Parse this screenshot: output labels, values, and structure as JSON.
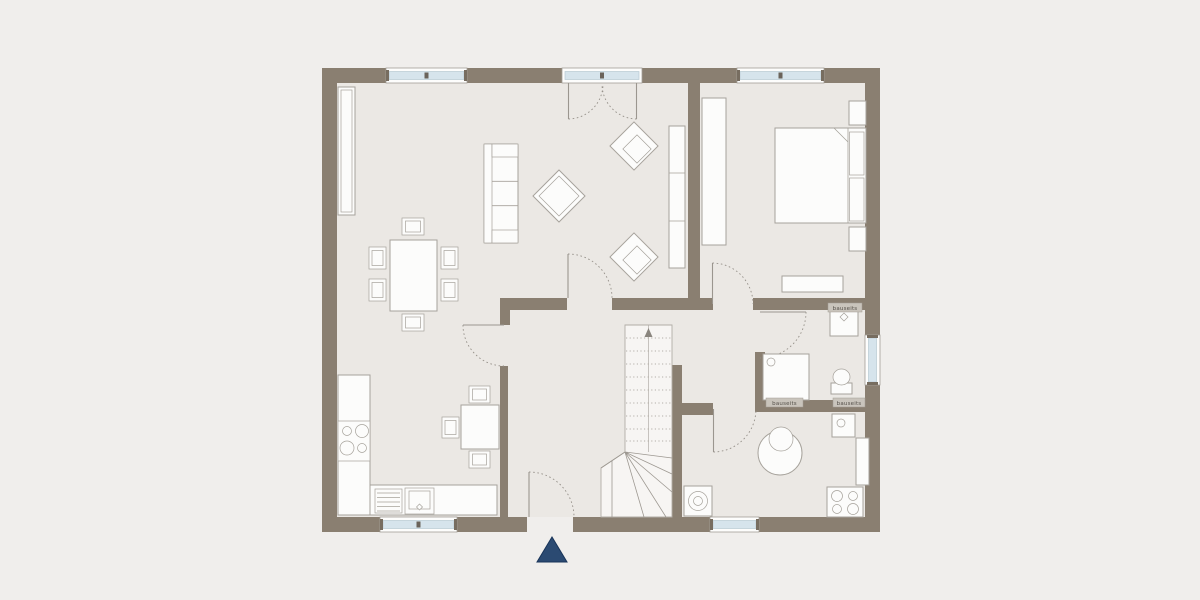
{
  "labels": {
    "washbasin_note": "bauseits",
    "shower_note": "bauseits",
    "toilet_note": "bauseits"
  },
  "colors": {
    "background": "#f0eeec",
    "floor": "#ebe8e4",
    "wall": "#8a7f71",
    "window_glass": "#d6e4ec",
    "furniture_fill": "#fcfcfb",
    "furniture_stroke": "#a6a29b",
    "door_arc": "#96918a",
    "stair_line": "#9d9891",
    "label_strip": "#c9c4bc",
    "label_text": "#55504a",
    "entrance_marker": "#2b4a72"
  },
  "icons": {
    "entrance_marker": "triangle-up",
    "stair_direction": "arrow-up"
  },
  "rooms": [
    {
      "name": "living-dining-room",
      "furniture": [
        "shelf",
        "dining-table",
        "dining-chairs-x6",
        "sofa",
        "coffee-table",
        "armchair-x2",
        "tv-board"
      ]
    },
    {
      "name": "bedroom",
      "furniture": [
        "wardrobe",
        "double-bed",
        "nightstand-x2",
        "bench"
      ]
    },
    {
      "name": "bathroom",
      "furniture": [
        "washbasin",
        "shower",
        "toilet"
      ]
    },
    {
      "name": "kitchen",
      "furniture": [
        "counter-l-shape",
        "cooktop",
        "sink-with-drainer",
        "table",
        "chairs-x3"
      ]
    },
    {
      "name": "utility-room",
      "furniture": [
        "washing-machine",
        "boiler",
        "small-washbasin",
        "counter",
        "cooktop"
      ]
    },
    {
      "name": "hallway",
      "furniture": [
        "winder-staircase"
      ]
    }
  ]
}
